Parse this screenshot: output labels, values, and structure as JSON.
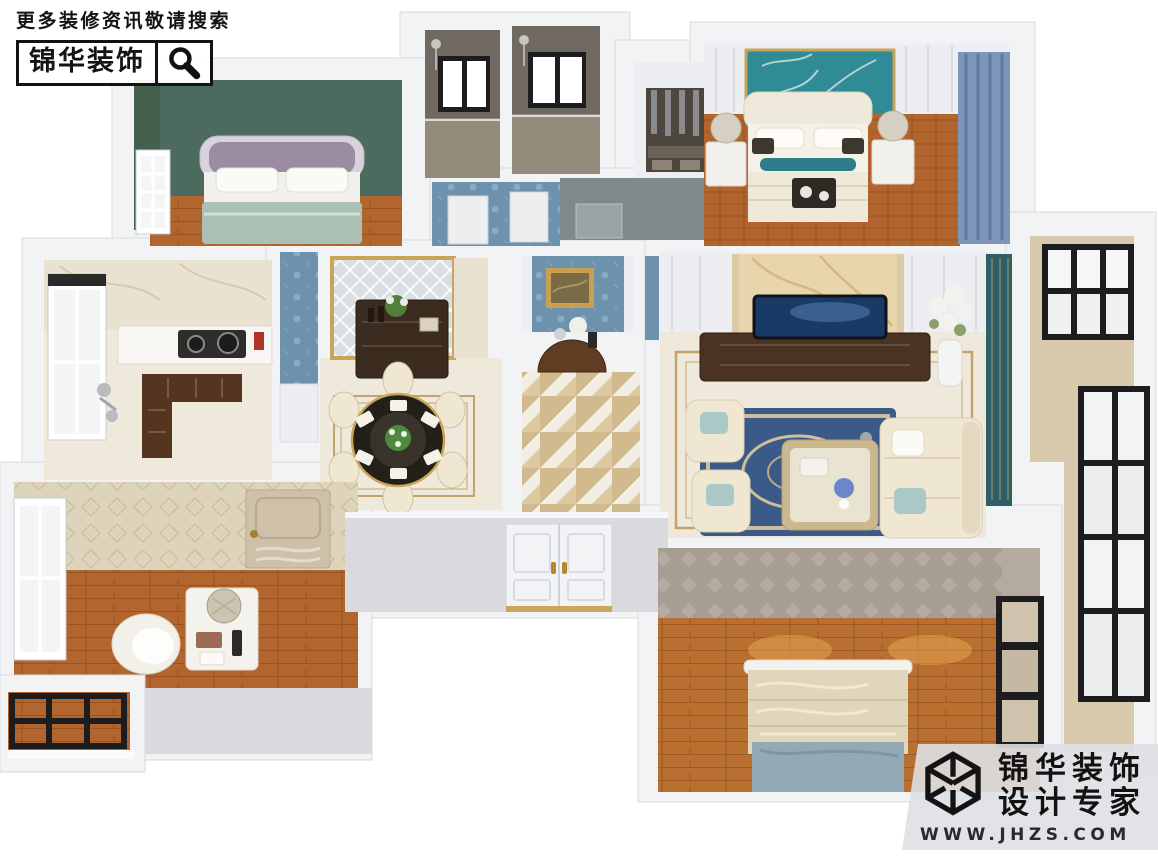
{
  "scene": {
    "type": "3d-apartment-floorplan-render",
    "rooms": [
      "bedroom-north",
      "bathroom-left",
      "bathroom-right",
      "walk-in-closet",
      "master-bedroom",
      "kitchen",
      "dining-room",
      "foyer-hallway",
      "living-room",
      "study",
      "balcony-right",
      "balcony-small",
      "bedroom-south",
      "entry-double-door"
    ]
  },
  "watermark_top_left": {
    "slogan": "更多装修资讯敬请搜索",
    "brand": "锦华装饰",
    "icon": "magnifier-icon"
  },
  "watermark_bottom_right": {
    "brand": "锦华装饰",
    "tagline": "设计专家",
    "website": "WWW.JHZS.COM",
    "icon": "cube-logo-icon"
  },
  "colors": {
    "wall-top": "#f2f3f5",
    "wall-edge": "#d7dade",
    "wall-shade": "#e2e4e8",
    "green-wall": "#4d6a5e",
    "wood": "#b2662e",
    "wood2": "#b96f2f",
    "bath-tile": "#6f6962",
    "bath-floor": "#948b7c",
    "glass": "#f3f5f6",
    "frame-black": "#1d1d1f",
    "blue-damask": "#6c92ae",
    "teal-floral": "#2f8b96",
    "panel-white": "#eceef1",
    "gold-trim": "#c9a45a",
    "parquet": "#b2642d",
    "curtain-blue": "#7d95b8",
    "curtain-teal": "#2f6068",
    "marble-wall": "#eae2d1",
    "marble-tv": "#e8d5ac",
    "marble-vein": "#c9a96b",
    "floor-cream": "#efe9dc",
    "cabinet-brown": "#54351f",
    "table-black": "#232019",
    "rug-blue": "#3c5a87",
    "sofa-cream": "#efe7d2",
    "pillow-teal": "#aac9c6",
    "tile-tri": "#cfb98d",
    "tile-base": "#f3eee3",
    "console-wood": "#5f3c22",
    "art-gold": "#c8a04f",
    "art-canvas": "#7a6a45",
    "door-beige": "#cfc0aa",
    "wallpaper-beige": "#ded3bb",
    "wallpaper-gray": "#a89d92",
    "desk-white": "#f4f2ec",
    "screen-blue": "#1a3a66",
    "balcony-floor": "#d8c9ac",
    "entry-gray": "#d8dade",
    "bed1-head": "#9a8da1",
    "bed1-frame": "#d8d2dc",
    "bed1-blanket": "#a9c0b4",
    "closet-dark": "#4c463f",
    "graygreen-wall": "#7e898c",
    "wm-band": "rgba(223,224,227,0.9)"
  }
}
